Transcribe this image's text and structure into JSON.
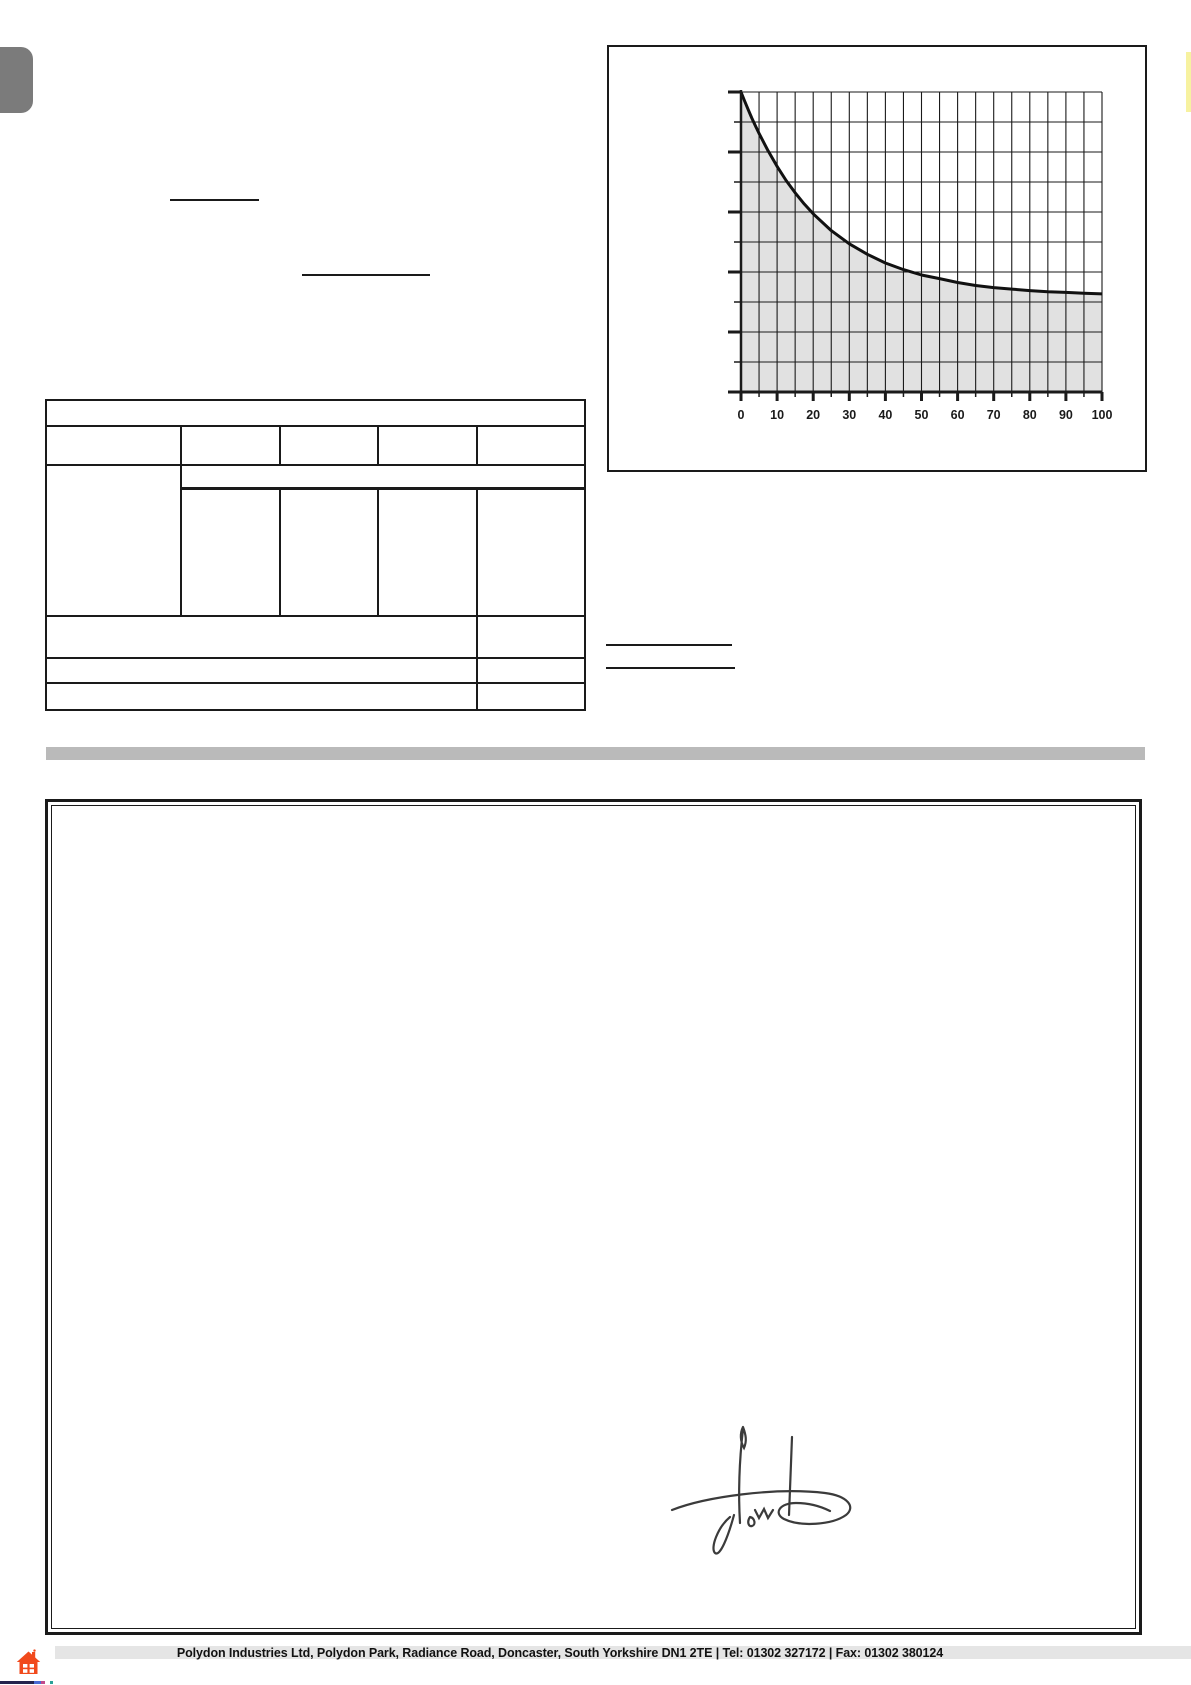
{
  "page": {
    "background": "#ffffff",
    "description": "Scanned blank product form page with performance chart, empty specification table, divider bar, double-bordered guarantee box with signature, and company footer"
  },
  "colors": {
    "ink": "#1a1a1a",
    "side_tab_gray": "#7b7b7b",
    "divider_gray": "#bababa",
    "chart_fill_gray": "#e1e1e1",
    "footer_band_gray": "#dcdcdc",
    "house_icon_orange": "#f14a1c",
    "edge_strip_yellow": "#f7f2a0",
    "signature_ink": "#3b3b3b"
  },
  "chart_data": {
    "type": "area",
    "title": "",
    "subtitle": "",
    "xlabel": "",
    "ylabel": "",
    "xlim": [
      0,
      100
    ],
    "ylim_fraction": [
      0,
      1
    ],
    "x_tick_labels": [
      "0",
      "10",
      "20",
      "30",
      "40",
      "50",
      "60",
      "70",
      "80",
      "90",
      "100"
    ],
    "x_minor_step": 5,
    "y_tick_count": 11,
    "y_tick_labels": [],
    "grid": "on",
    "legend": "none",
    "curve_color": "#111111",
    "fill_color": "#e1e1e1",
    "description": "Exponential decay curve starting at full height at x=0 and flattening toward an asymptote near one third of plot height; area under curve shaded gray; y-axis ticks unlabeled, alternating long and short",
    "series": [
      {
        "name": "decay-curve",
        "fill_to_zero": true,
        "x": [
          0,
          1,
          2,
          3,
          4,
          5,
          7.5,
          10,
          12.5,
          15,
          17.5,
          20,
          25,
          30,
          35,
          40,
          45,
          50,
          55,
          60,
          65,
          70,
          75,
          80,
          85,
          90,
          95,
          100
        ],
        "y_fraction": [
          1.0,
          0.97,
          0.941,
          0.913,
          0.887,
          0.862,
          0.804,
          0.752,
          0.705,
          0.664,
          0.627,
          0.594,
          0.538,
          0.494,
          0.459,
          0.43,
          0.408,
          0.39,
          0.378,
          0.365,
          0.355,
          0.348,
          0.343,
          0.338,
          0.334,
          0.332,
          0.329,
          0.327
        ]
      }
    ]
  },
  "form": {
    "table_content": "empty",
    "blank_lines_count": 4
  },
  "certificate_box": {
    "content": "empty except handwritten signature near bottom center"
  },
  "signature": {
    "present": true,
    "style": "handwritten scrawl with loops and descender"
  },
  "footer": {
    "company_line": {
      "address": "Polydon Industries Ltd, Polydon Park, Radiance Road, Doncaster, South Yorkshire DN1 2TE",
      "sep1": "|",
      "tel_label": "Tel:",
      "tel_number": "01302 327172",
      "sep2": "|",
      "fax_label": "Fax:",
      "fax_number": "01302 380124"
    }
  }
}
